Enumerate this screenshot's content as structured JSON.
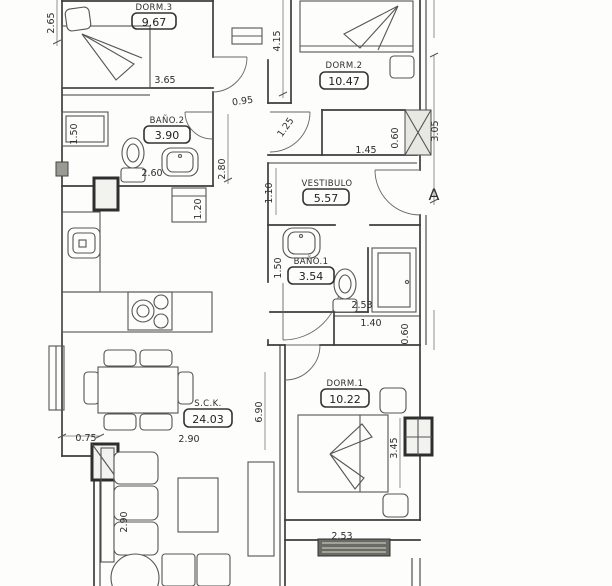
{
  "plan": {
    "title": "apartment-floor-plan",
    "marker": "A",
    "rooms": [
      {
        "name": "DORM.3",
        "area": "9.67"
      },
      {
        "name": "DORM.2",
        "area": "10.47"
      },
      {
        "name": "BAÑO.2",
        "area": "3.90"
      },
      {
        "name": "VESTIBULO",
        "area": "5.57"
      },
      {
        "name": "BAÑO.1",
        "area": "3.54"
      },
      {
        "name": "DORM.1",
        "area": "10.22"
      },
      {
        "name": "S.C.K.",
        "area": "24.03"
      }
    ],
    "dimensions": [
      {
        "t": "2.65"
      },
      {
        "t": "3.65"
      },
      {
        "t": "0.95"
      },
      {
        "t": "4.15"
      },
      {
        "t": "1.50"
      },
      {
        "t": "2.60"
      },
      {
        "t": "2.80"
      },
      {
        "t": "1.20"
      },
      {
        "t": "1.25"
      },
      {
        "t": "1.45"
      },
      {
        "t": "0.60"
      },
      {
        "t": "3.05"
      },
      {
        "t": "1.10"
      },
      {
        "t": "1.50"
      },
      {
        "t": "2.53"
      },
      {
        "t": "1.40"
      },
      {
        "t": "0.60"
      },
      {
        "t": "3.45"
      },
      {
        "t": "6.90"
      },
      {
        "t": "0.75"
      },
      {
        "t": "2.90"
      },
      {
        "t": "2.90"
      },
      {
        "t": "2.53"
      }
    ]
  }
}
